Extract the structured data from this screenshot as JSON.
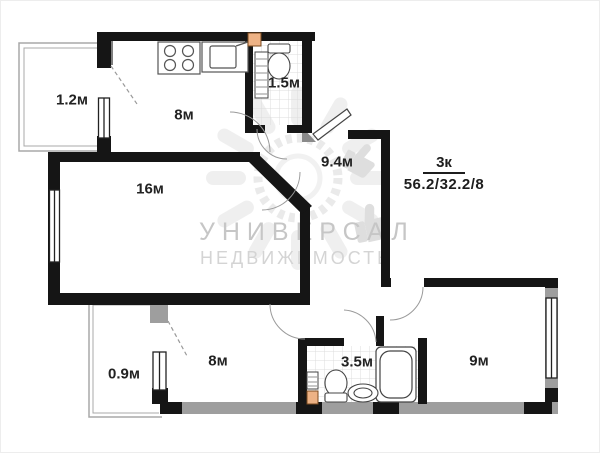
{
  "plan_title": {
    "type_label": "3к",
    "areas": "56.2/32.2/8"
  },
  "watermark": {
    "line1": "УНИВЕРСАЛ",
    "line2": "НЕДВИЖИМОСТЬ"
  },
  "rooms": {
    "balcony_top_left": {
      "label": "1.2м"
    },
    "kitchen": {
      "label": "8м"
    },
    "bathroom_top": {
      "label": "1.5м"
    },
    "hallway": {
      "label": "9.4м"
    },
    "living_room": {
      "label": "16м"
    },
    "balcony_bottom_left": {
      "label": "0.9м"
    },
    "room_bottom_left": {
      "label": "8м"
    },
    "bathroom_bottom": {
      "label": "3.5м"
    },
    "room_bottom_right": {
      "label": "9м"
    }
  },
  "colors": {
    "wall_black": "#151515",
    "wall_gray": "#9e9e9e",
    "tile_line": "#dcdcdc",
    "watermark_text": "#c6c6c6",
    "fixture_accent_orange": "#edb285",
    "label_text": "#222222"
  },
  "icons": {
    "stove": "stove-icon",
    "kitchen_sink": "kitchen-sink-icon",
    "toilet_top": "toilet-icon",
    "radiator_top": "radiator-grille-icon",
    "bathtub": "bathtub-icon",
    "toilet_bottom": "toilet-icon",
    "washbasin": "washbasin-icon",
    "radiator_bottom": "radiator-grille-icon",
    "sun_logo": "sun-logo-watermark-icon"
  }
}
